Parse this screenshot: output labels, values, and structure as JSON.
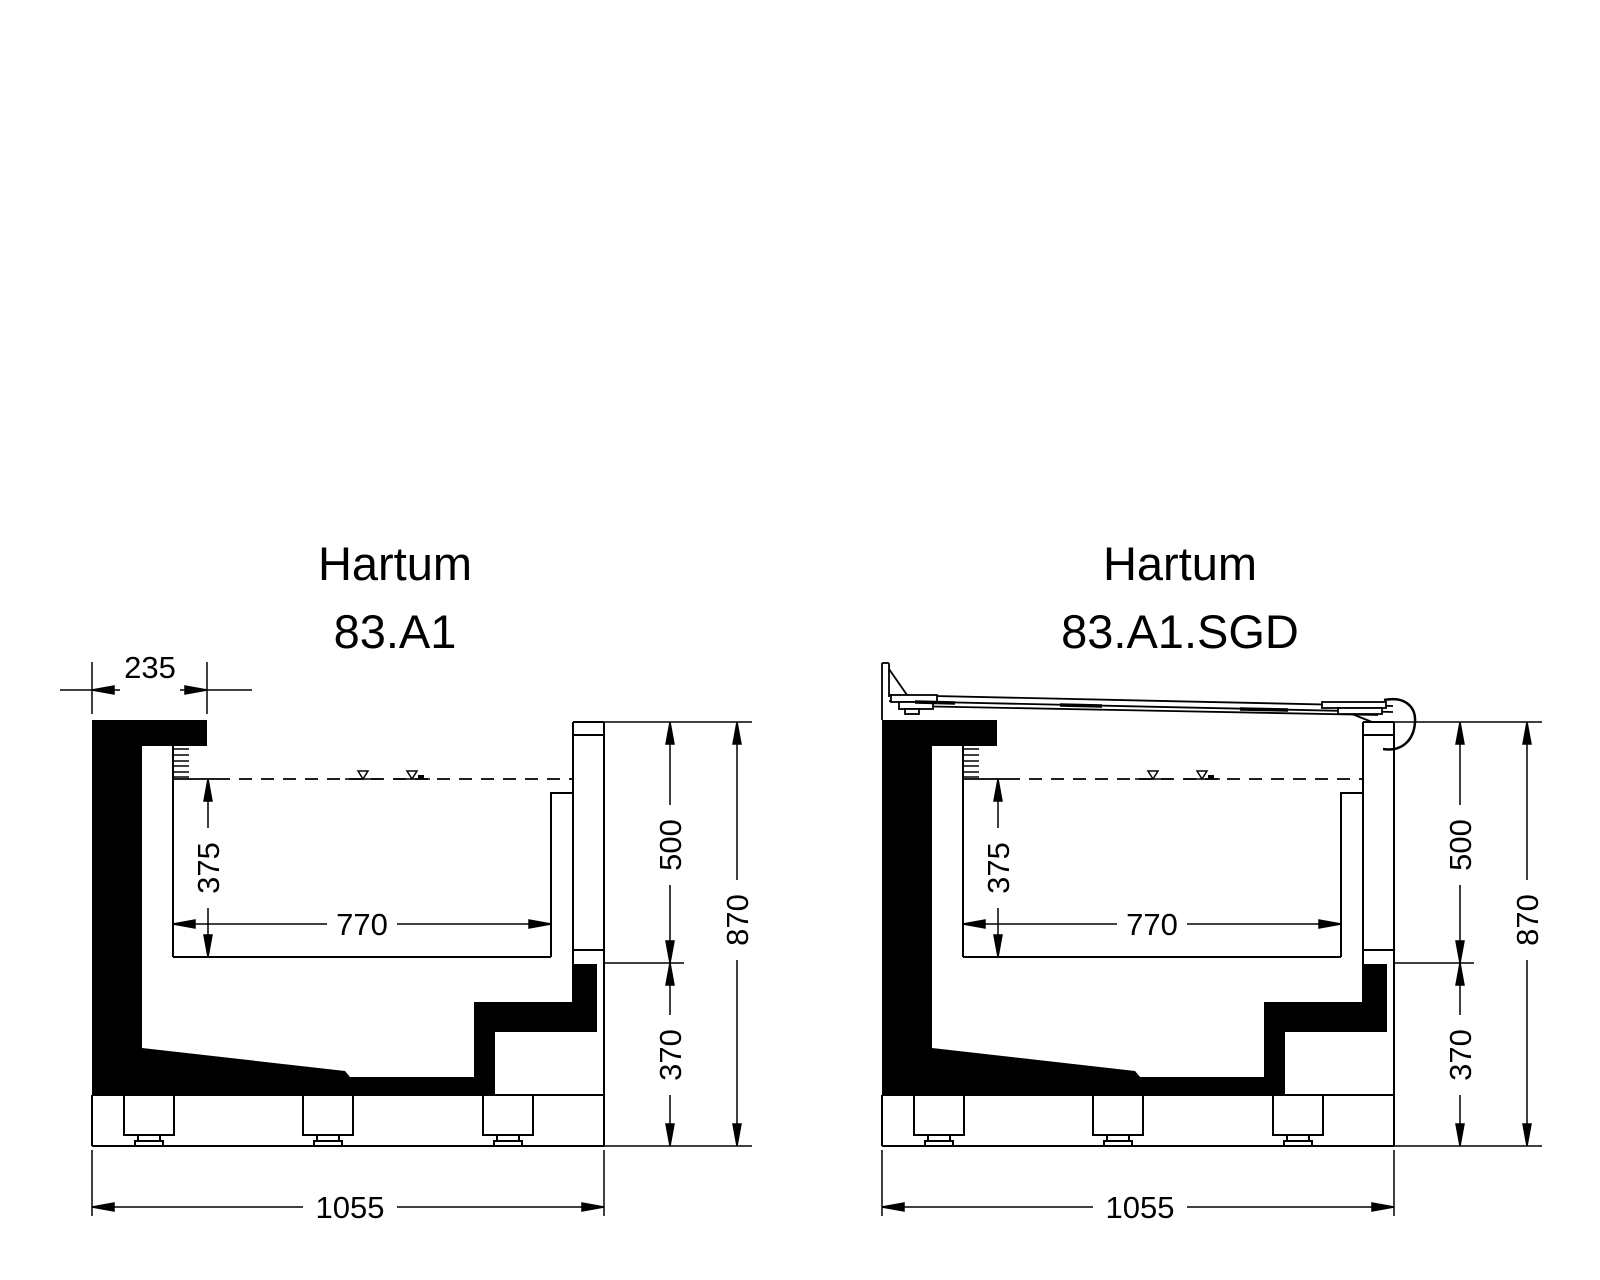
{
  "page": {
    "background_color": "#ffffff",
    "line_color": "#000000"
  },
  "drawings": {
    "left": {
      "title_line1": "Hartum",
      "title_line2": "83.A1",
      "dims": {
        "flange_width": "235",
        "tub_depth": "375",
        "tub_width": "770",
        "upper_height": "500",
        "total_height": "870",
        "lower_height": "370",
        "total_width": "1055"
      }
    },
    "right": {
      "title_line1": "Hartum",
      "title_line2": "83.A1.SGD",
      "dims": {
        "tub_depth": "375",
        "tub_width": "770",
        "upper_height": "500",
        "total_height": "870",
        "lower_height": "370",
        "total_width": "1055"
      }
    }
  }
}
